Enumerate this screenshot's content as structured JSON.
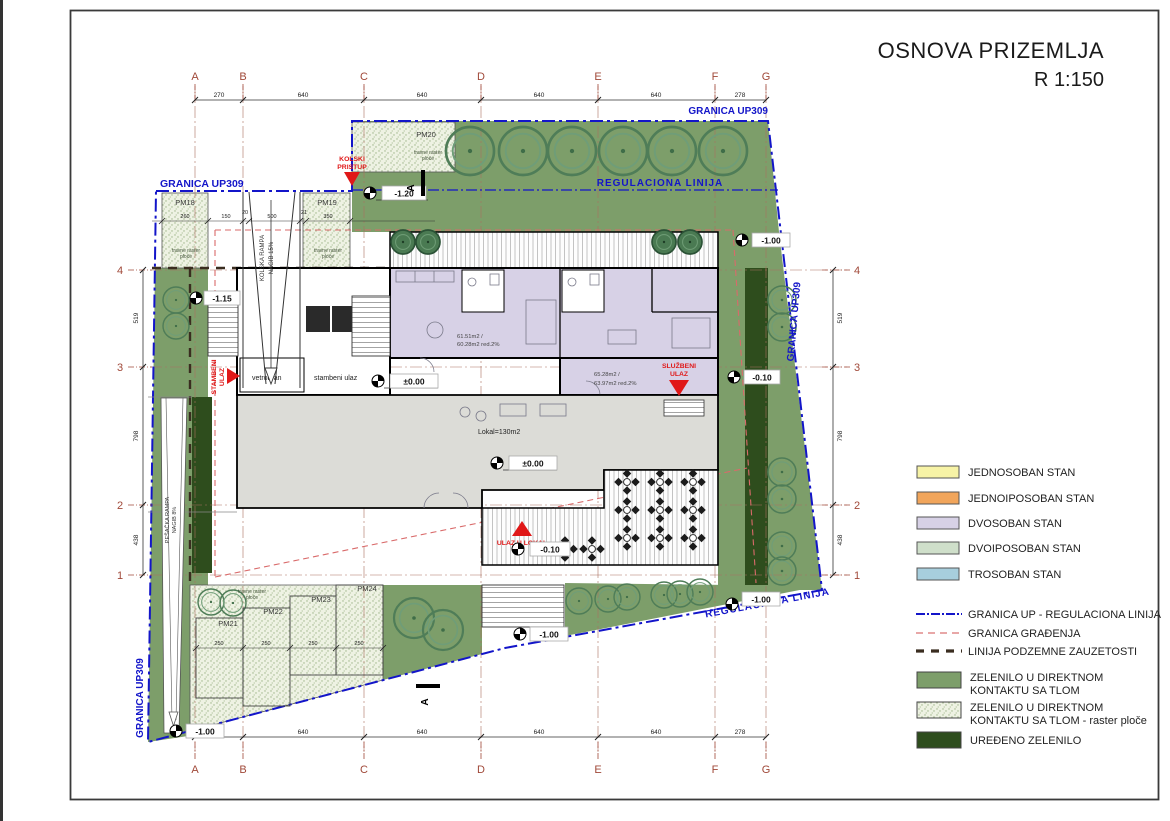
{
  "title": {
    "main": "OSNOVA PRIZEMLJA",
    "scale": "R 1:150"
  },
  "legend": {
    "apartments": [
      {
        "label": "JEDNOSOBAN STAN",
        "color": "#f7f3a6"
      },
      {
        "label": "JEDNOIPOSOBAN STAN",
        "color": "#f1a55b"
      },
      {
        "label": "DVOSOBAN STAN",
        "color": "#d7d1e6"
      },
      {
        "label": "DVOIPOSOBAN STAN",
        "color": "#cfdfca"
      },
      {
        "label": "TROSOBAN STAN",
        "color": "#a7cedd"
      }
    ],
    "lines": [
      {
        "label": "GRANICA UP - REGULACIONA LINIJA",
        "color": "#1315c9"
      },
      {
        "label": "GRANICA GRAĐENJA",
        "color": "#e08a8a"
      },
      {
        "label": "LINIJA PODZEMNE ZAUZETOSTI",
        "color": "#3a2d20"
      }
    ],
    "greens": [
      {
        "l1": "ZELENILO U DIREKTNOM",
        "l2": "KONTAKTU SA TLOM",
        "color": "#7d9e6a"
      },
      {
        "l1": "ZELENILO U DIREKTNOM",
        "l2": "KONTAKTU SA TLOM - raster ploče",
        "color": "#edf2e3"
      },
      {
        "l1": "UREĐENO ZELENILO",
        "l2": "",
        "color": "#2e4d1d"
      }
    ]
  },
  "axes": {
    "letters": [
      "A",
      "B",
      "C",
      "D",
      "E",
      "F",
      "G"
    ],
    "top_dims": [
      "270",
      "640",
      "640",
      "640",
      "640",
      "278"
    ],
    "numbers": [
      "4",
      "3",
      "2",
      "1"
    ],
    "side_dims": [
      "519",
      "798",
      "438"
    ]
  },
  "boundary": {
    "granica": "GRANICA UP309",
    "regulaciona": "REGULACIONA LINIJA"
  },
  "labels": {
    "kolski_l1": "KOLSKI",
    "kolski_l2": "PRISTUP",
    "stambeni_l1": "STAMBENI",
    "stambeni_l2": "ULAZ",
    "sluzbeni_l1": "SLUŽBENI",
    "sluzbeni_l2": "ULAZ",
    "ulaz_lokal": "ULAZ U LOKAL",
    "vetrobran": "vetrobran",
    "stambeni_ulaz": "stambeni ulaz",
    "lokal": "Lokal=130m2",
    "apt1_l1": "61.51m2 /",
    "apt1_l2": "60.28m2 red.2%",
    "apt2_l1": "65.28m2 /",
    "apt2_l2": "63.97m2 red.2%",
    "kolska_rampa": "KOLSKA RAMPA",
    "kolska_nagib": "NAGIB 15%",
    "pesacka_rampa": "PEŠAČKA RAMPA",
    "pesacka_nagib": "NAGIB 8%",
    "section": "A",
    "raster_note_l1": "travne raster",
    "raster_note_l2": "ploče"
  },
  "levels": {
    "m120": "-1.20",
    "m115": "-1.15",
    "zero": "±0.00",
    "m010": "-0.10",
    "m100": "-1.00"
  },
  "parking": {
    "pm18": "PM18",
    "pm19": "PM19",
    "pm20": "PM20",
    "pm21": "PM21",
    "pm22": "PM22",
    "pm23": "PM23",
    "pm24": "PM24",
    "inner_dims": [
      "260",
      "150",
      "20",
      "500",
      "21",
      "350"
    ],
    "stall_dim": "250"
  }
}
